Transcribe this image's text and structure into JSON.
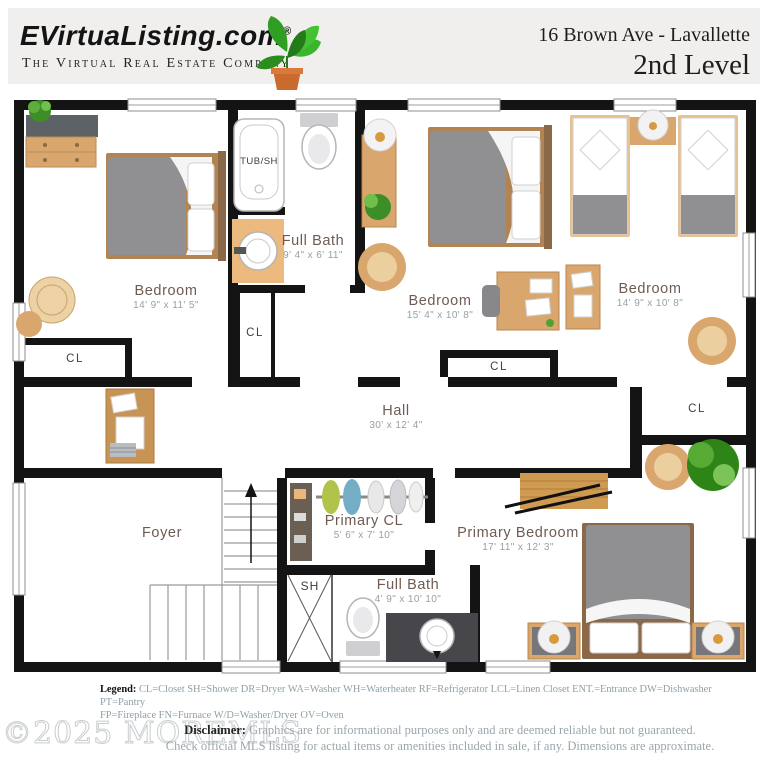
{
  "header": {
    "brand": "EVirtuaListing.com",
    "registered": "®",
    "tagline": "The Virtual Real Estate Company",
    "address": "16 Brown Ave - Lavallette",
    "level": "2nd Level"
  },
  "rooms": [
    {
      "name": "Bedroom",
      "dims": "14' 9\" x 11' 5\""
    },
    {
      "name": "Full Bath",
      "dims": "9' 4\" x 6' 11\""
    },
    {
      "name": "Bedroom",
      "dims": "15' 4\" x 10' 8\""
    },
    {
      "name": "Bedroom",
      "dims": "14' 9\" x 10' 8\""
    },
    {
      "name": "Hall",
      "dims": "30' x 12' 4\""
    },
    {
      "name": "Foyer",
      "dims": ""
    },
    {
      "name": "Primary CL",
      "dims": "5' 6\" x 7' 10\""
    },
    {
      "name": "Primary Bedroom",
      "dims": "17' 11\" x 12' 3\""
    },
    {
      "name": "Full Bath",
      "dims": "4' 9\" x 10' 10\""
    }
  ],
  "closets": [
    "CL",
    "CL",
    "CL",
    "CL"
  ],
  "fixtures": {
    "tub_shower": "TUB/SH",
    "shower": "SH"
  },
  "legend": {
    "label": "Legend:",
    "line1": "CL=Closet SH=Shower DR=Dryer  WA=Washer  WH=Waterheater RF=Refrigerator  LCL=Linen Closet  ENT.=Entrance DW=Dishwasher PT=Pantry",
    "line2": "FP=Fireplace FN=Furnace W/D=Washer/Dryer OV=Oven"
  },
  "disclaimer": {
    "label": "Disclaimer:",
    "line1": "Graphics are for informational purposes only and are deemed reliable but not guaranteed.",
    "line2": "Check official MLS listing for actual items or amenities included in sale, if any.  Dimensions are approximate."
  },
  "watermark": "©2025 MOREMLS",
  "colors": {
    "wall": "#141414",
    "wood": "#d9a76e",
    "plant_green": "#2e8416",
    "room_label": "#6e5b51",
    "dims_text": "#98a0a3"
  }
}
